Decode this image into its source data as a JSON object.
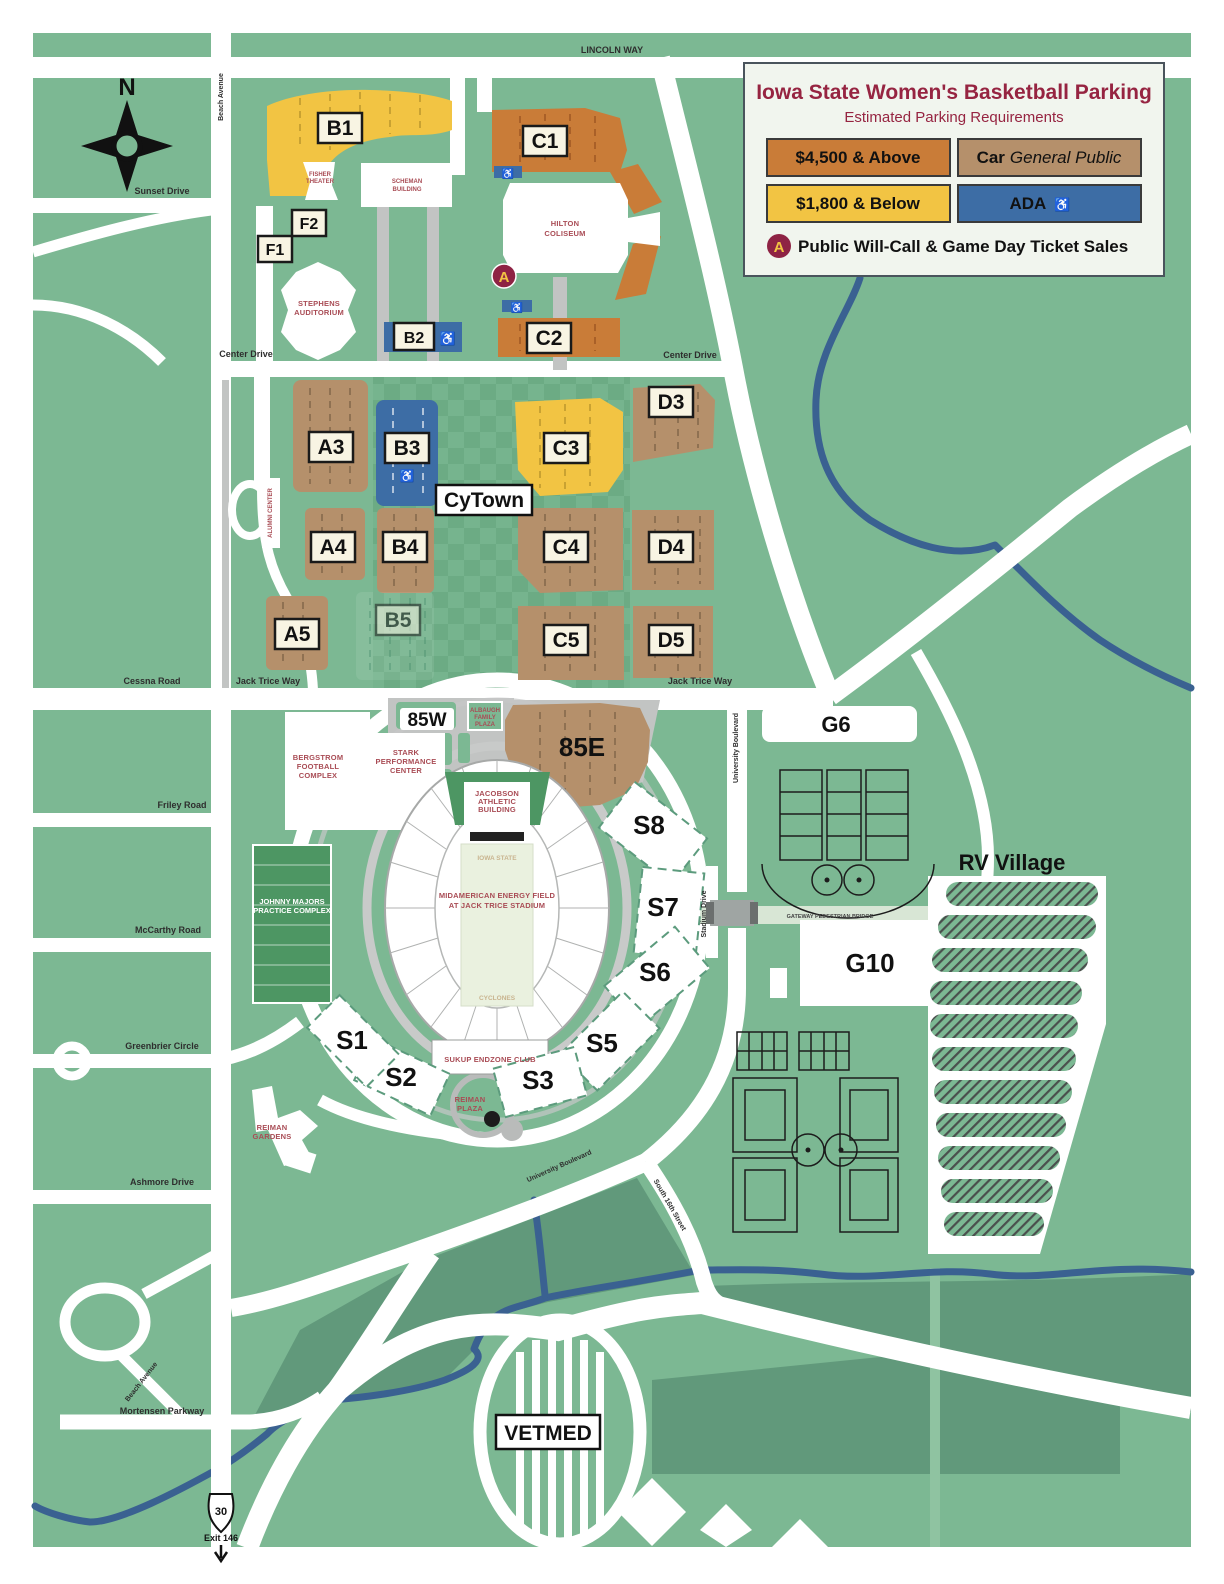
{
  "colors": {
    "background_green": "#7CB893",
    "dark_green": "#61997B",
    "tier_high_orange": "#C97C38",
    "tier_low_yellow": "#F2C443",
    "car_general_tan": "#B5906B",
    "ada_blue": "#3D6DA5",
    "road_white": "#FFFFFF",
    "river_blue": "#3A6191",
    "title_maroon": "#962441",
    "building_label_red": "#A94C55",
    "marker_gold": "#F2C443"
  },
  "legend": {
    "title": "Iowa State Women's Basketball Parking",
    "subtitle": "Estimated Parking Requirements",
    "tier_high": "$4,500 & Above",
    "tier_low": "$1,800 & Below",
    "car_bold": "Car",
    "car_italic": "General Public",
    "ada_label": "ADA",
    "ada_icon": "♿",
    "marker_letter": "A",
    "willcall": "Public Will-Call & Game Day Ticket Sales"
  },
  "compass": {
    "north": "N"
  },
  "roads": {
    "lincoln_way": "LINCOLN WAY",
    "beach_avenue": "Beach Avenue",
    "sunset_drive": "Sunset Drive",
    "center_drive": "Center Drive",
    "cessna_road": "Cessna Road",
    "jack_trice_way": "Jack Trice Way",
    "friley_road": "Friley Road",
    "mccarthy_road": "McCarthy Road",
    "greenbrier_circle": "Greenbrier Circle",
    "ashmore_drive": "Ashmore Drive",
    "mortensen_parkway": "Mortensen Parkway",
    "university_boulevard": "University Boulevard",
    "south_16th_street": "South 16th Street",
    "stadium_drive": "Stadium Drive",
    "gateway_bridge": "GATEWAY PEDESTRIAN BRIDGE",
    "us30": "30",
    "exit_146": "Exit 146"
  },
  "lots": {
    "b1": "B1",
    "f1": "F1",
    "f2": "F2",
    "b2": "B2",
    "c1": "C1",
    "c2": "C2",
    "a3": "A3",
    "b3": "B3",
    "c3": "C3",
    "d3": "D3",
    "a4": "A4",
    "b4": "B4",
    "c4": "C4",
    "d4": "D4",
    "a5": "A5",
    "b5": "B5",
    "c5": "C5",
    "d5": "D5",
    "w85": "85W",
    "e85": "85E",
    "s1": "S1",
    "s2": "S2",
    "s3": "S3",
    "s5": "S5",
    "s6": "S6",
    "s7": "S7",
    "s8": "S8",
    "g6": "G6",
    "g10": "G10"
  },
  "places": {
    "cytown": "CyTown",
    "rv_village": "RV Village",
    "vetmed": "VETMED",
    "scheman": [
      "SCHEMAN",
      "BUILDING"
    ],
    "fisher": [
      "FISHER",
      "THEATER"
    ],
    "stephens": [
      "STEPHENS",
      "AUDITORIUM"
    ],
    "hilton": [
      "HILTON",
      "COLISEUM"
    ],
    "alumni_center": "ALUMNI CENTER",
    "bergstrom": [
      "BERGSTROM",
      "FOOTBALL",
      "COMPLEX"
    ],
    "stark": [
      "STARK",
      "PERFORMANCE",
      "CENTER"
    ],
    "albaugh": [
      "ALBAUGH",
      "FAMILY",
      "PLAZA"
    ],
    "jacobson": [
      "JACOBSON",
      "ATHLETIC",
      "BUILDING"
    ],
    "field": [
      "MIDAMERICAN ENERGY FIELD",
      "AT JACK TRICE STADIUM"
    ],
    "endzone_north": "IOWA STATE",
    "endzone_south": "CYCLONES",
    "sukup": "SUKUP ENDZONE CLUB",
    "johnny_majors": [
      "JOHNNY MAJORS",
      "PRACTICE COMPLEX"
    ],
    "reiman_gardens": [
      "REIMAN",
      "GARDENS"
    ],
    "reiman_plaza": [
      "REIMAN",
      "PLAZA"
    ]
  }
}
